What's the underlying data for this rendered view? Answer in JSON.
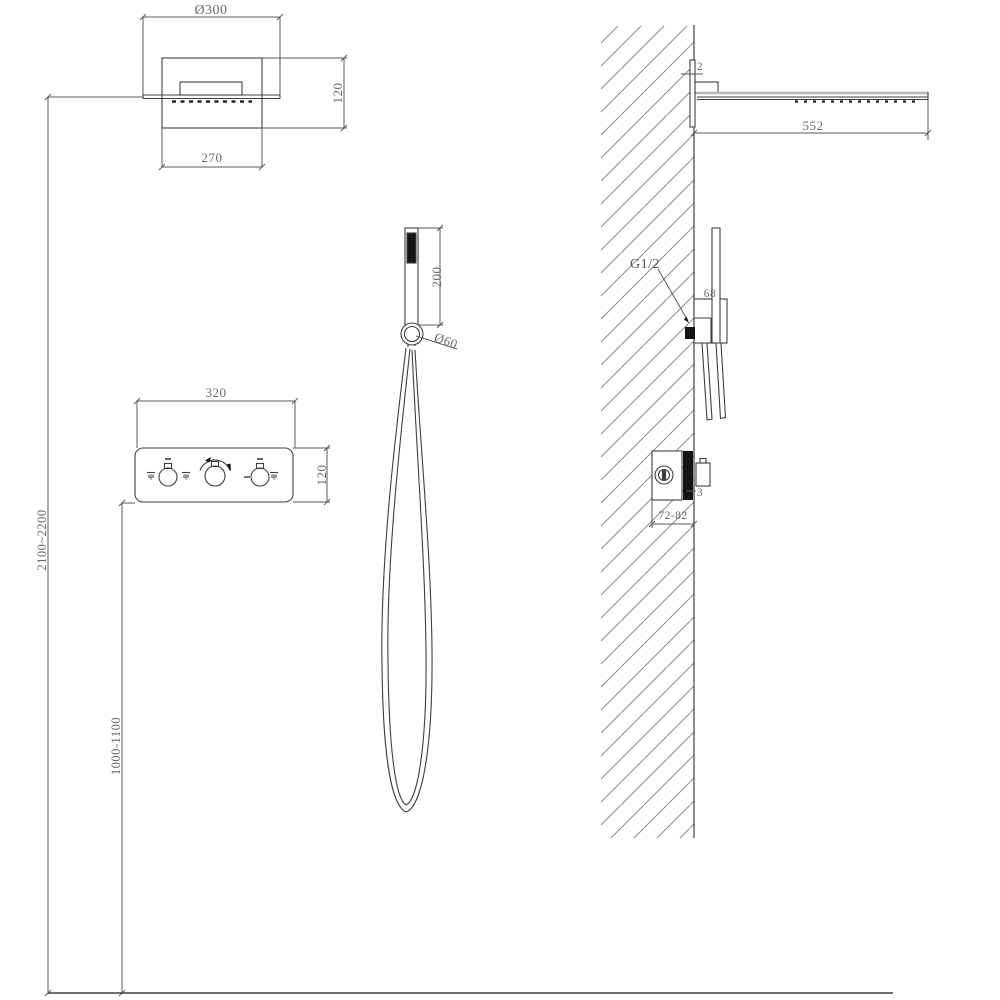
{
  "background": "#ffffff",
  "colors": {
    "object_line": "#3f3f3f",
    "dimension_line": "#5a5a5a",
    "light_line": "#b5b5b5",
    "dim_text": "#6a6a6a",
    "solid_fill": "#141414",
    "hatch_line": "#8a8a8a"
  },
  "views": {
    "front": {
      "rain_shower_head": {
        "diameter": "Ø300",
        "depth": "120",
        "width": "270"
      },
      "thermostatic_panel": {
        "width": "320",
        "height": "120",
        "knob_icons": [
          "overhead-spray-icon",
          "hand-spray-icon",
          "rotation-arrow-icon",
          "minus-icon",
          "spray-icon"
        ]
      },
      "hand_shower": {
        "wand_length": "200",
        "holder_diameter": "Ø60"
      },
      "installation_heights": {
        "rain_head_to_floor": "2100~2200",
        "panel_to_floor": "1000-1100"
      }
    },
    "side": {
      "rain_shower_head": {
        "plate_thickness": "2",
        "wall_projection": "552"
      },
      "hand_shower_outlet": {
        "thread_size": "G1/2",
        "holder_size": "68"
      },
      "concealed_valve": {
        "faceplate_thickness": "3",
        "embed_depth_range": "72-82"
      }
    }
  }
}
